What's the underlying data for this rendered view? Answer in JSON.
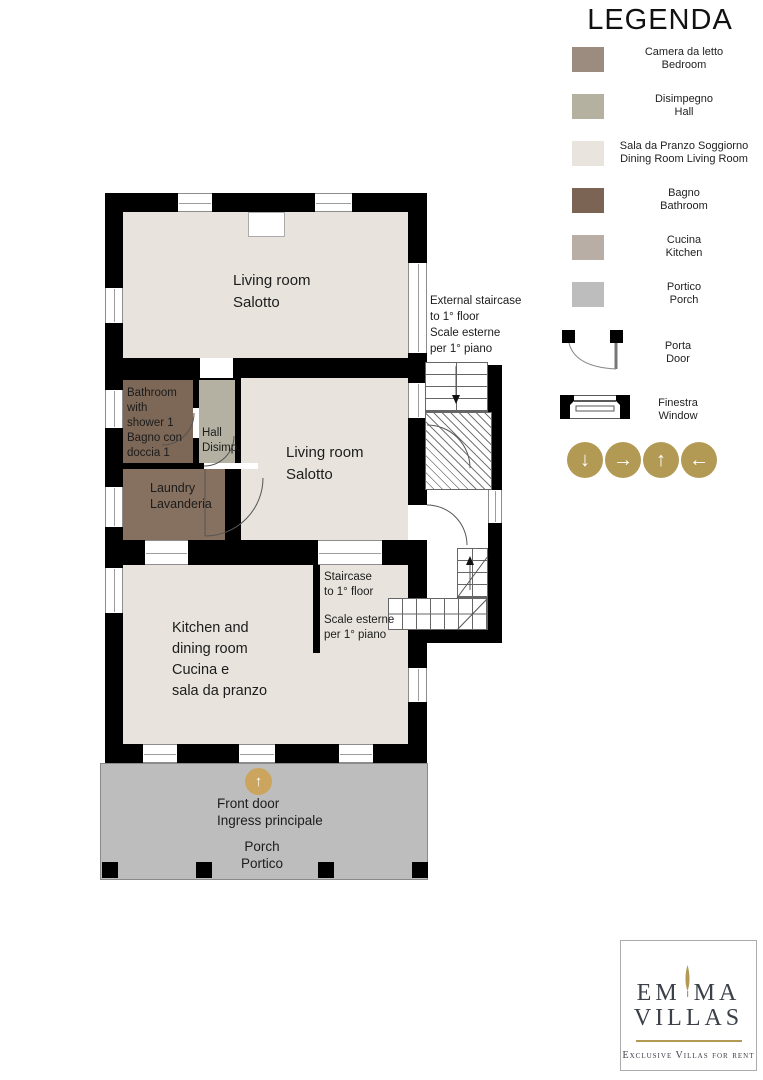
{
  "colors": {
    "wall": "#000000",
    "room_cream": "#E8E4DD",
    "room_bathroom": "#7D6756",
    "room_laundry": "#86705F",
    "room_hall": "#B4B1A2",
    "porch_gray": "#BDBDBD",
    "gold": "#B29A55",
    "gold_light": "#CBA55E",
    "logo_text": "#3C4049"
  },
  "legend": {
    "title": "LEGENDA",
    "items": [
      {
        "color": "#9C8B7F",
        "line1": "Camera da letto",
        "line2": "Bedroom"
      },
      {
        "color": "#B4B1A1",
        "line1": "Disimpegno",
        "line2": "Hall"
      },
      {
        "color": "#E9E5DE",
        "line1": "Sala da Pranzo  Soggiorno",
        "line2": "Dining Room  Living Room"
      },
      {
        "color": "#7B6453",
        "line1": "Bagno",
        "line2": "Bathroom"
      },
      {
        "color": "#B8AEA5",
        "line1": "Cucina",
        "line2": "Kitchen"
      },
      {
        "color": "#BDBDBD",
        "line1": "Portico",
        "line2": "Porch"
      }
    ],
    "door": {
      "line1": "Porta",
      "line2": "Door"
    },
    "window": {
      "line1": "Finestra",
      "line2": "Window"
    },
    "arrow_glyphs": [
      "↓",
      "→",
      "↑",
      "←"
    ]
  },
  "plan": {
    "rooms": {
      "living1": {
        "lines": [
          "Living room",
          "Salotto"
        ]
      },
      "living2": {
        "lines": [
          "Living room",
          "Salotto"
        ]
      },
      "bathroom": {
        "lines": [
          "Bathroom",
          "with",
          "shower 1",
          "Bagno con",
          "doccia 1"
        ]
      },
      "hall": {
        "lines": [
          "Hall",
          "Disimp."
        ]
      },
      "laundry": {
        "lines": [
          "Laundry",
          "Lavanderia"
        ]
      },
      "kitchen": {
        "lines": [
          "Kitchen and",
          "dining room",
          "Cucina e",
          "sala da pranzo"
        ]
      }
    },
    "staircase_internal": {
      "lines": [
        "Staircase",
        "to 1° floor"
      ],
      "lines2": [
        "Scale esterne",
        "per 1° piano"
      ]
    },
    "staircase_external": {
      "lines": [
        "External staircase",
        "to 1° floor",
        "Scale esterne",
        "per 1° piano"
      ]
    },
    "front_door": {
      "arrow": "↑",
      "line1": "Front door",
      "line2": "Ingress principale"
    },
    "porch": {
      "line1": "Porch",
      "line2": "Portico"
    }
  },
  "logo": {
    "word1_left": "EM",
    "word1_right": "MA",
    "word2": "VILLAS",
    "tagline": "Exclusive Villas for rent"
  }
}
